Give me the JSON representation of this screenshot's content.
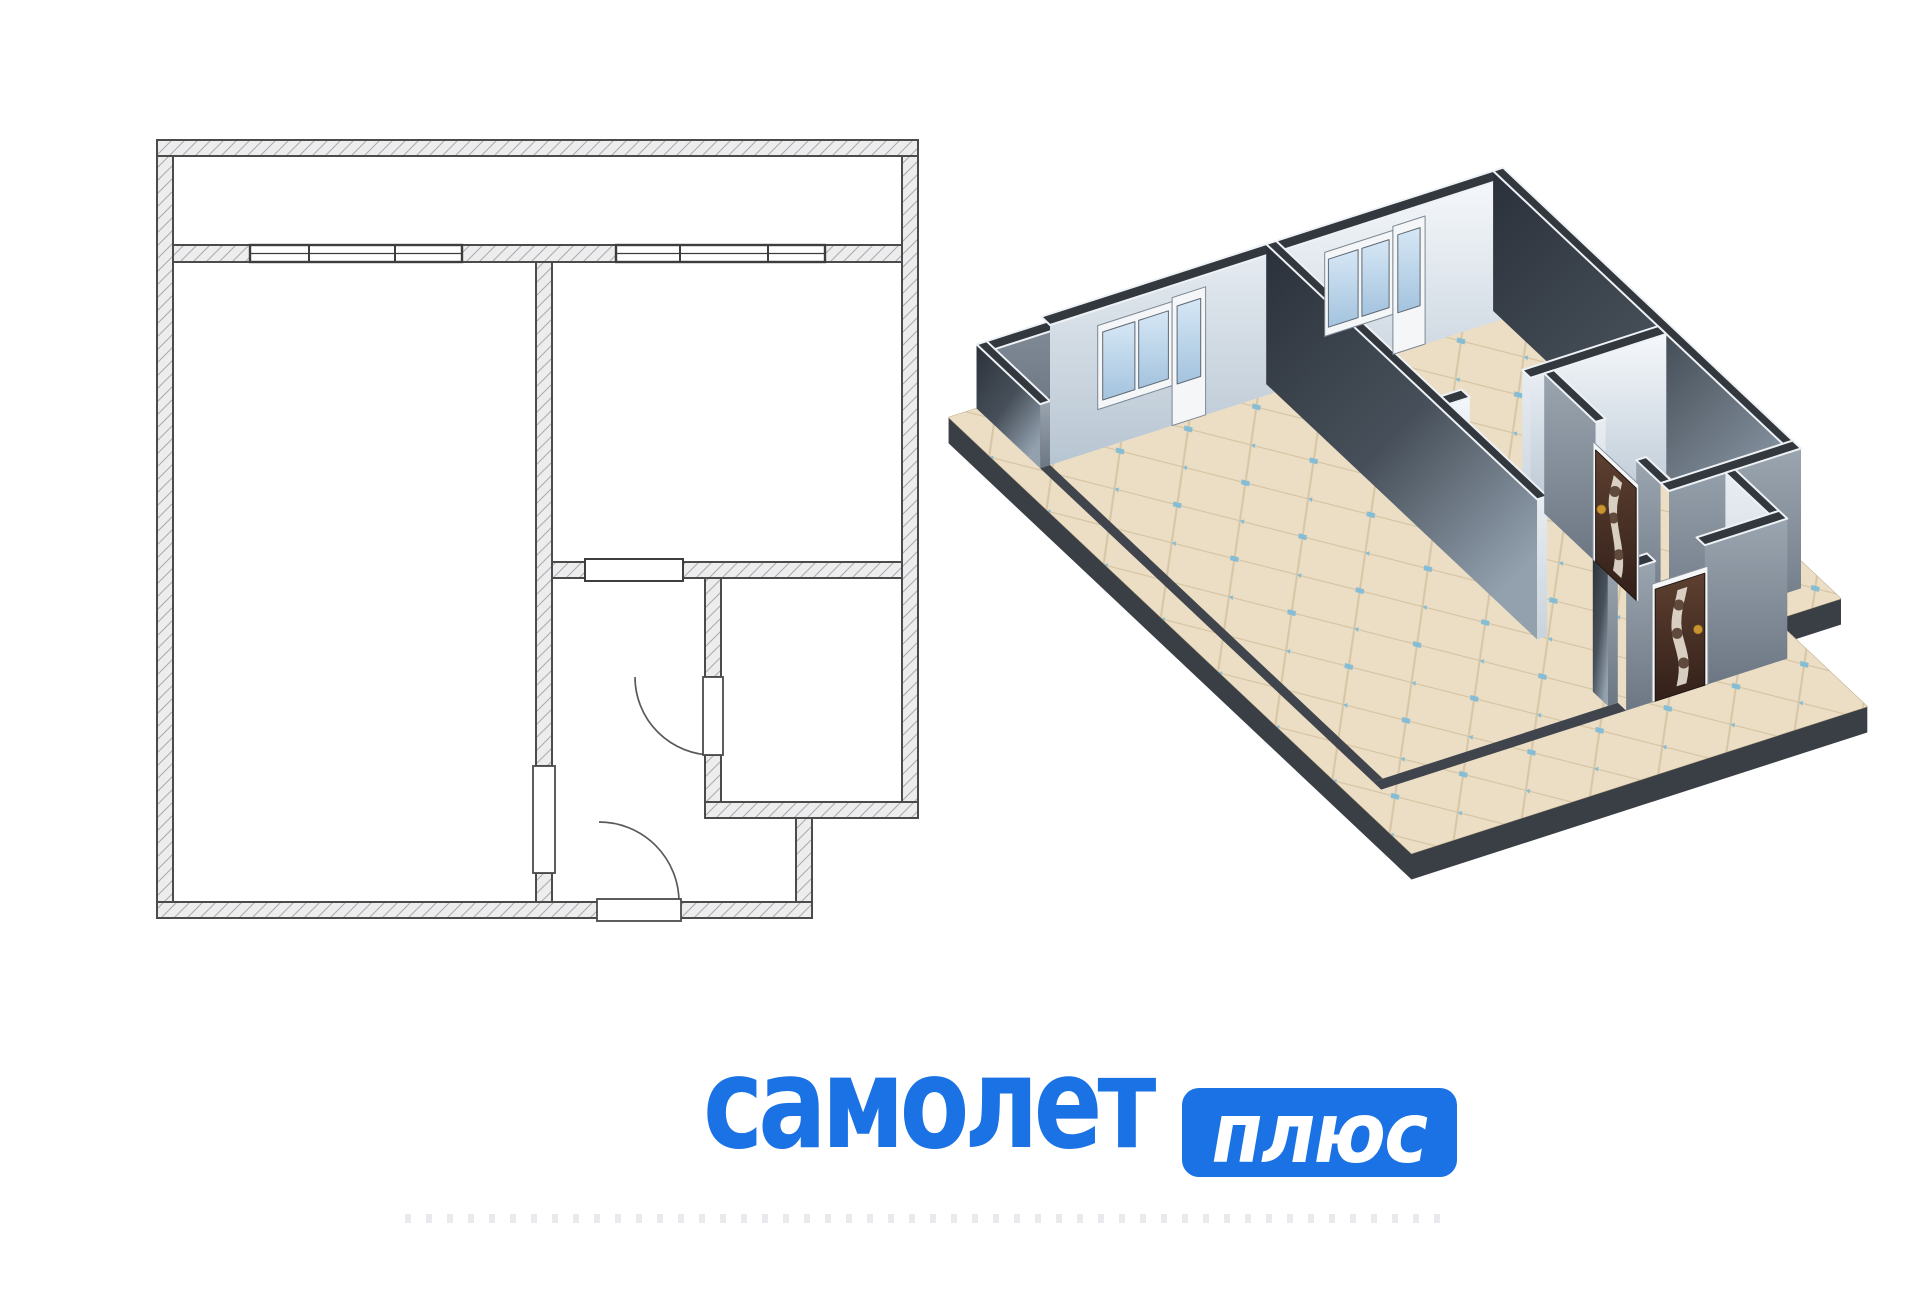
{
  "page": {
    "width": 1920,
    "height": 1294,
    "background": "#ffffff"
  },
  "logo": {
    "word": "самолет",
    "badge": "плюс",
    "blue": "#1a72e4",
    "badge_text_color": "#ffffff"
  },
  "watermark": {
    "present": true
  },
  "floorplan_2d": {
    "stroke": "#4b4b4b",
    "hatch_color": "#a9aeb5",
    "wall_fill": "#ededed",
    "symbol_stroke": "#3d3d3d",
    "walls": [
      [
        157,
        140,
        918,
        156
      ],
      [
        157,
        156,
        173,
        918
      ],
      [
        902,
        156,
        918,
        818
      ],
      [
        157,
        902,
        599,
        918
      ],
      [
        679,
        902,
        812,
        918
      ],
      [
        705,
        802,
        918,
        818
      ],
      [
        796,
        818,
        812,
        902
      ],
      [
        173,
        245,
        250,
        262
      ],
      [
        462,
        245,
        616,
        262
      ],
      [
        825,
        245,
        902,
        262
      ],
      [
        536,
        262,
        552,
        766
      ],
      [
        536,
        873,
        552,
        902
      ],
      [
        552,
        562,
        585,
        578
      ],
      [
        683,
        562,
        902,
        578
      ],
      [
        705,
        578,
        721,
        677
      ],
      [
        705,
        755,
        721,
        802
      ]
    ],
    "window_groups": [
      {
        "x1": 250,
        "x2": 462,
        "y1": 245,
        "y2": 262,
        "dividers": [
          309,
          395
        ]
      },
      {
        "x1": 616,
        "x2": 825,
        "y1": 245,
        "y2": 262,
        "dividers": [
          680,
          768
        ]
      }
    ],
    "sill": [
      585,
      559,
      683,
      581
    ],
    "door_leaves": [
      [
        533,
        766,
        555,
        873
      ],
      [
        703,
        677,
        723,
        755
      ],
      [
        597,
        899,
        681,
        921
      ]
    ],
    "arcs": [
      "M713,755 A78,78 0 0 1 635,677",
      "M679,902 A80,80 0 0 0 599,822"
    ]
  },
  "view_3d": {
    "transform": {
      "ox": 1050,
      "oy": 465,
      "px": 173,
      "py": 262,
      "ex": [
        0.62,
        -0.2
      ],
      "ey": [
        0.52,
        0.49
      ],
      "wall_h": 140,
      "parapet_h": 64,
      "slab_depth": 26
    },
    "colors": {
      "top": "#33383f",
      "top_edge": "#eef2f6",
      "slab_side": "#3a3f46",
      "slab_line": "#bcab8b",
      "floor_base": "#ebdec4",
      "tile_line": "#d7c5a5",
      "tile_dot": "#85bcd6",
      "balcony_floor": "#636b75",
      "footprint": "#40454d",
      "frame_white": "#f4f6f8",
      "glass_hi": "#d6e7f5",
      "glass_lo": "#a3c3de",
      "door_brown_hi": "#5d4030",
      "door_brown_lo": "#33201a",
      "door_stripe": "#e3dccf",
      "handle": "#c9942f",
      "grad_dark": [
        "#2b313a",
        "#47505a",
        "#93a1af"
      ],
      "grad_light": [
        "#f5f8fb",
        "#b7c5d2"
      ],
      "grad_med": [
        "#9aa5b0",
        "#6c7783"
      ],
      "grad_pale": [
        "#e8edf2",
        "#c9d3dc"
      ]
    },
    "slab_poly": [
      [
        112,
        140
      ],
      [
        953,
        140
      ],
      [
        953,
        853
      ],
      [
        847,
        853
      ],
      [
        847,
        1030
      ],
      [
        112,
        1030
      ]
    ],
    "balcony_floor": [
      173,
      156,
      902,
      245
    ],
    "footprints": [
      [
        157,
        262,
        173,
        902
      ],
      [
        157,
        902,
        552,
        918
      ]
    ],
    "walls": [
      {
        "r": [
          902,
          140,
          918,
          245
        ],
        "h": 64,
        "w": "med",
        "s": "none"
      },
      {
        "r": [
          157,
          140,
          918,
          156
        ],
        "h": 64,
        "w": "dark",
        "s": "med"
      },
      {
        "r": [
          157,
          140,
          173,
          262
        ],
        "h": 64,
        "w": "dark",
        "s": "med"
      },
      {
        "r": [
          173,
          245,
          902,
          262
        ],
        "h": 140,
        "w": "none",
        "s": "light"
      },
      {
        "r": [
          902,
          245,
          918,
          818
        ],
        "h": 140,
        "w": "dark",
        "s": "none"
      },
      {
        "r": [
          552,
          562,
          585,
          578
        ],
        "h": 140,
        "w": "none",
        "s": "light"
      },
      {
        "r": [
          683,
          562,
          902,
          578
        ],
        "h": 140,
        "w": "pale",
        "s": "light"
      },
      {
        "r": [
          536,
          245,
          552,
          766
        ],
        "h": 140,
        "w": "dark",
        "s": "pale"
      },
      {
        "r": [
          536,
          873,
          552,
          902
        ],
        "h": 140,
        "w": "dark",
        "s": "med"
      },
      {
        "r": [
          705,
          578,
          721,
          677
        ],
        "h": 140,
        "w": "med",
        "s": "pale"
      },
      {
        "r": [
          705,
          755,
          721,
          802
        ],
        "h": 140,
        "w": "med",
        "s": "none"
      },
      {
        "r": [
          705,
          802,
          918,
          818
        ],
        "h": 140,
        "w": "none",
        "s": "med"
      },
      {
        "r": [
          796,
          818,
          812,
          902
        ],
        "h": 140,
        "w": "pale",
        "s": "none"
      },
      {
        "r": [
          552,
          902,
          599,
          918
        ],
        "h": 140,
        "w": "none",
        "s": "med"
      },
      {
        "r": [
          679,
          902,
          812,
          918
        ],
        "h": 140,
        "w": "none",
        "s": "med"
      }
    ],
    "windows": [
      {
        "at": 262,
        "win": [
          250,
          370
        ],
        "panes": [
          [
            258,
            310
          ],
          [
            316,
            364
          ]
        ],
        "door": [
          370,
          424
        ],
        "door_glass": [
          378,
          416
        ]
      },
      {
        "at": 262,
        "win": [
          616,
          726
        ],
        "panes": [
          [
            622,
            670
          ],
          [
            676,
            720
          ]
        ],
        "door": [
          726,
          778
        ],
        "door_glass": [
          734,
          770
        ]
      }
    ],
    "window_z": {
      "win": [
        40,
        124
      ],
      "pane": [
        48,
        116
      ],
      "door": [
        0,
        128
      ],
      "door_glass": [
        40,
        118
      ]
    },
    "doors": [
      {
        "plane": "x",
        "at": 705,
        "f1": 672,
        "f2": 760,
        "d1": 677,
        "d2": 755,
        "stripe": 716,
        "handle_a": 688,
        "handle_z": 58
      },
      {
        "plane": "y",
        "at": 918,
        "f1": 594,
        "f2": 684,
        "d1": 599,
        "d2": 679,
        "stripe": 639,
        "handle_a": 668,
        "handle_z": 58
      }
    ],
    "door_z": {
      "frame": 118,
      "door": 112
    }
  }
}
